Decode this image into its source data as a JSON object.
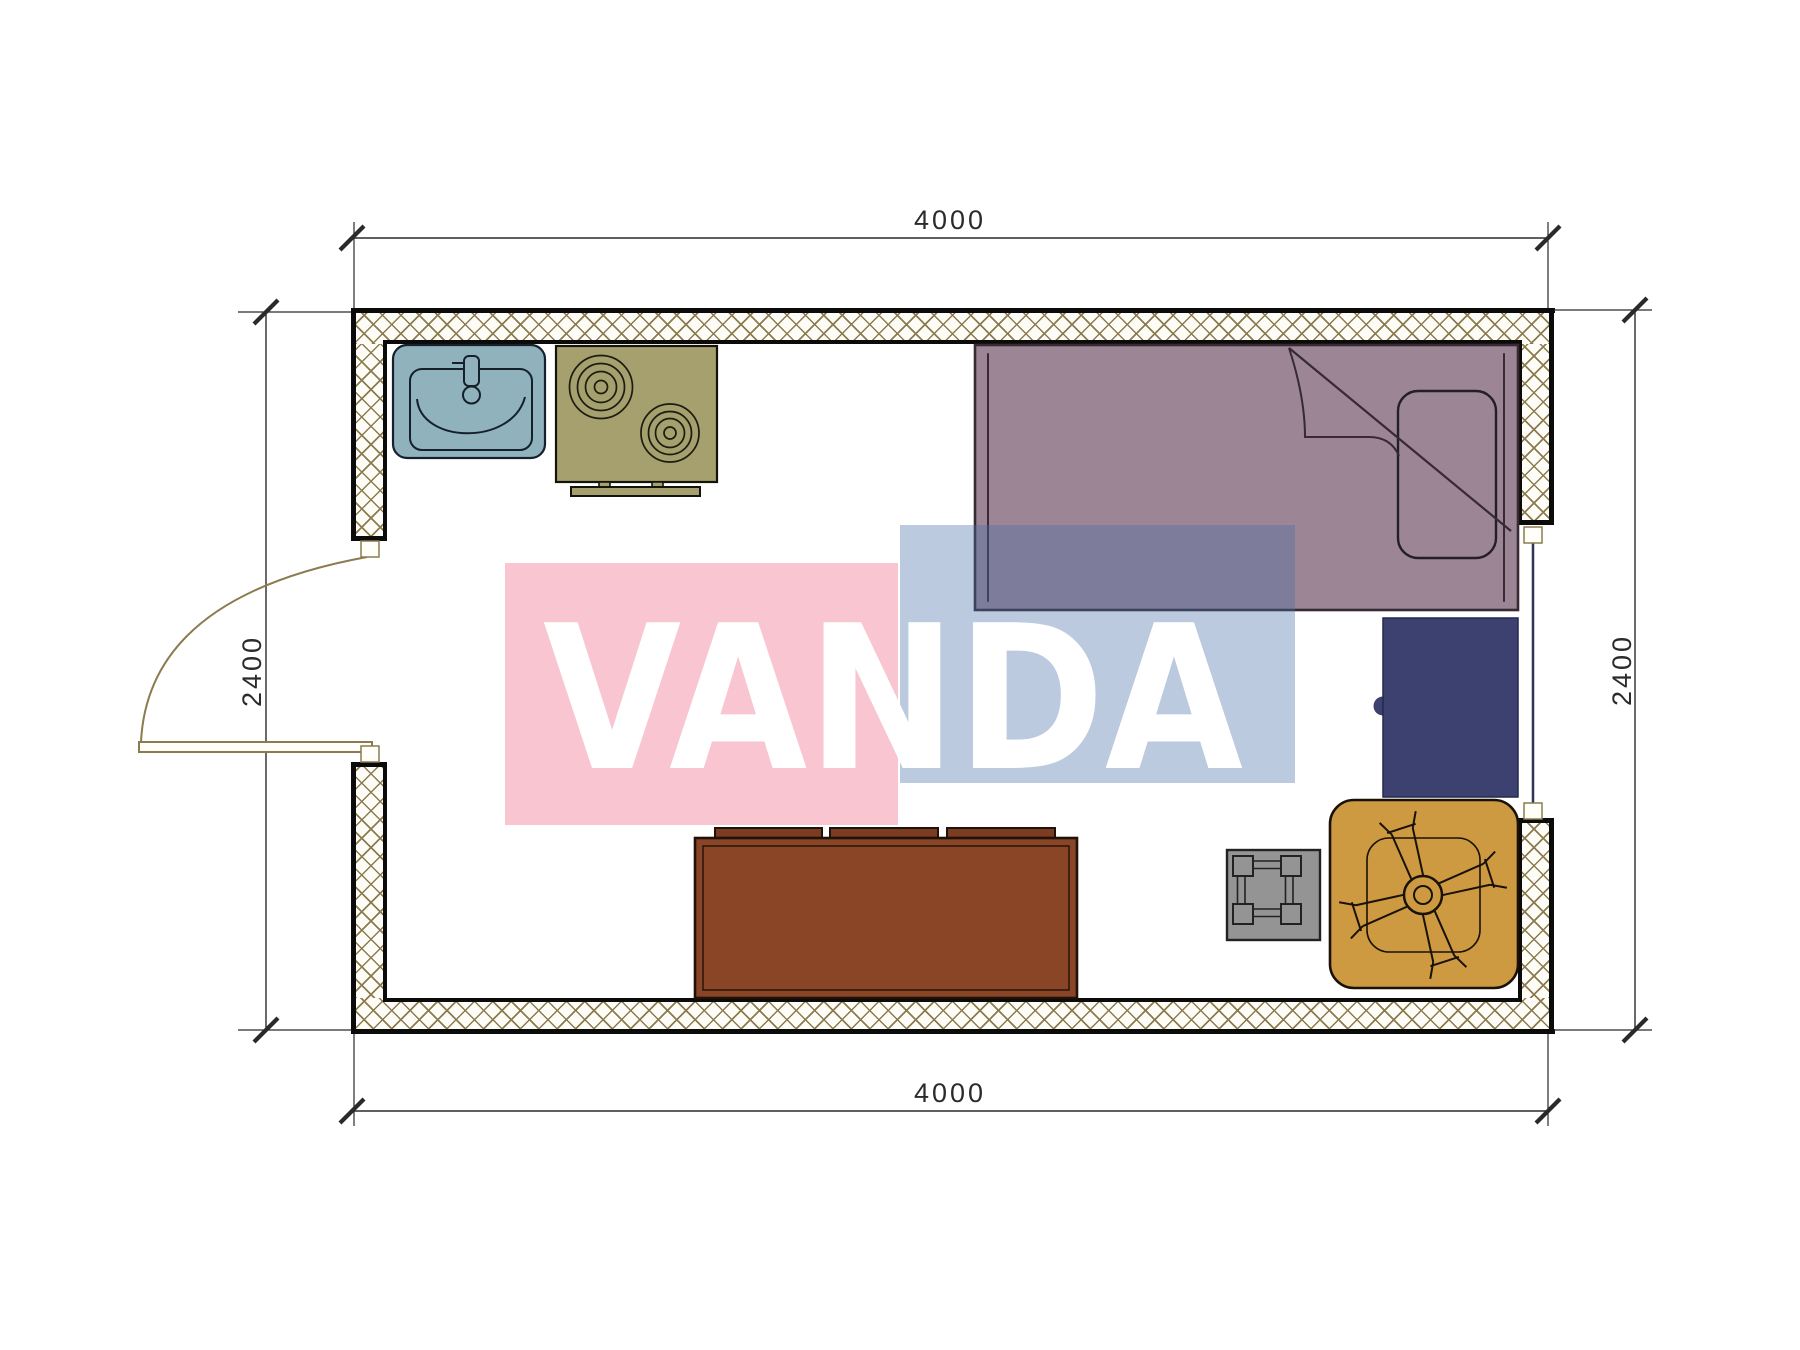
{
  "drawing": {
    "kind": "floor-plan",
    "room_width_mm": "4000",
    "room_depth_mm": "2400"
  },
  "dimensions": {
    "top": "4000",
    "bottom": "4000",
    "left": "2400",
    "right": "2400"
  },
  "watermark": {
    "text": "VANDA"
  },
  "furniture": [
    "sink",
    "stove",
    "bed",
    "pillow",
    "desk",
    "sofa",
    "stool-table",
    "swivel-armchair",
    "door",
    "window"
  ],
  "colors": {
    "wall_hatch": "#8c7b4e",
    "line_tan": "#8c7b4e",
    "sink": "#8fb2bc",
    "stove": "#a5a06d",
    "bed": "#9c8594",
    "bed_line": "#362a33",
    "desk": "#3c4170",
    "window_line": "#2e3658",
    "sofa": "#8a4527",
    "sofa_cushion": "#7b3c22",
    "stool": "#949494",
    "chair": "#cd9a41",
    "dim_line": "#2a2a2a",
    "watermark_pink": "rgba(236,98,128,0.37)",
    "watermark_blue": "rgba(74,112,168,0.37)",
    "watermark_text": "rgba(255,255,255,0.38)"
  }
}
